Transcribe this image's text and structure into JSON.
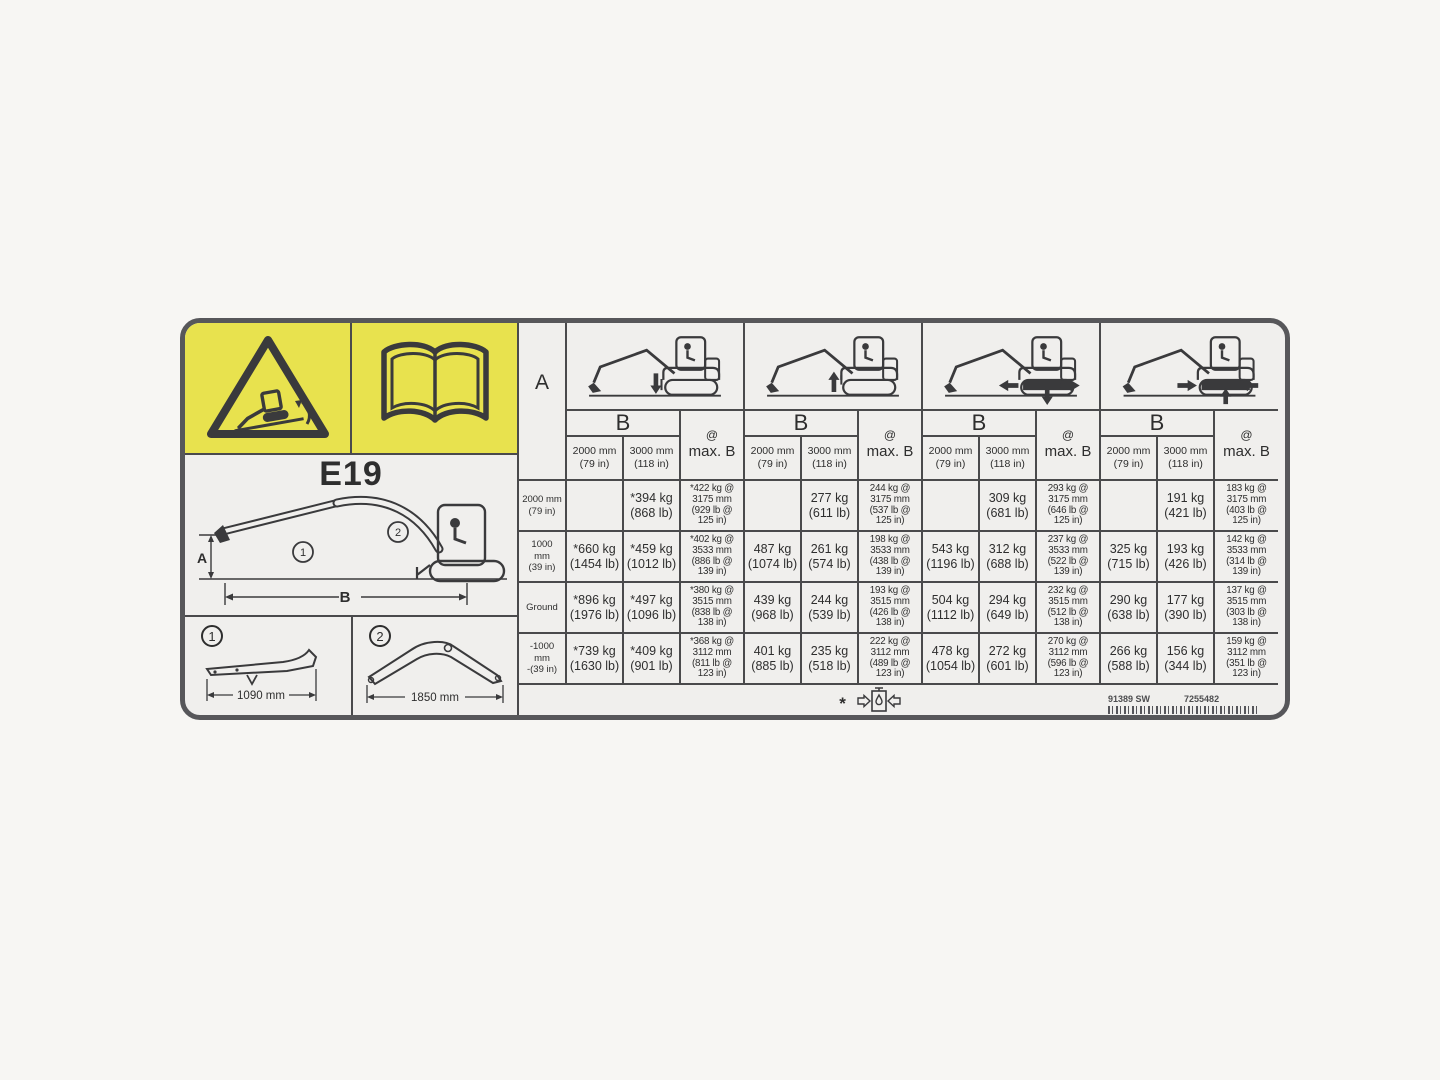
{
  "decal": {
    "model": "E19",
    "colors": {
      "panel_yellow": "#e8e24e",
      "border_gray": "#57575a",
      "background": "#f0efed",
      "line": "#4a4a4c"
    },
    "icons": {
      "warning": "tipping-excavator-warning-triangle",
      "manual": "operators-manual-book",
      "hydraulic": "hydraulic-capacity-limit",
      "group_icons": [
        "excavator-blade-down",
        "excavator-blade-up",
        "excavator-tracks-extended",
        "excavator-tracks-retracted"
      ]
    },
    "diagram": {
      "label_a": "A",
      "label_b": "B",
      "marker_1": "1",
      "marker_2": "2"
    },
    "arm_options": [
      {
        "marker": "1",
        "dimension": "1090 mm"
      },
      {
        "marker": "2",
        "dimension": "1850 mm"
      }
    ],
    "footer": {
      "asterisk": "*",
      "part_number_left": "91389 SW",
      "part_number_right": "7255482"
    }
  },
  "table": {
    "corner_label": "A",
    "b_label": "B",
    "at_symbol": "@",
    "max_b_label": "max. B",
    "b_columns": [
      "2000 mm\n(79 in)",
      "3000 mm\n(118 in)"
    ],
    "row_headers": [
      "2000 mm\n(79 in)",
      "1000\nmm\n(39 in)",
      "Ground",
      "-1000\nmm\n-(39 in)"
    ],
    "groups": [
      {
        "icon": "excavator-blade-down",
        "rows": [
          [
            "",
            "*394 kg\n(868 lb)",
            "*422 kg @\n3175 mm\n(929 lb @\n125 in)"
          ],
          [
            "*660 kg\n(1454 lb)",
            "*459 kg\n(1012 lb)",
            "*402 kg @\n3533 mm\n(886 lb @\n139 in)"
          ],
          [
            "*896 kg\n(1976 lb)",
            "*497 kg\n(1096 lb)",
            "*380 kg @\n3515 mm\n(838 lb @\n138 in)"
          ],
          [
            "*739 kg\n(1630 lb)",
            "*409 kg\n(901 lb)",
            "*368 kg @\n3112 mm\n(811 lb @\n123 in)"
          ]
        ]
      },
      {
        "icon": "excavator-blade-up",
        "rows": [
          [
            "",
            "277 kg\n(611 lb)",
            "244 kg @\n3175 mm\n(537 lb @\n125 in)"
          ],
          [
            "487 kg\n(1074 lb)",
            "261 kg\n(574 lb)",
            "198 kg @\n3533 mm\n(438 lb @\n139 in)"
          ],
          [
            "439 kg\n(968 lb)",
            "244 kg\n(539 lb)",
            "193 kg @\n3515 mm\n(426 lb @\n138 in)"
          ],
          [
            "401 kg\n(885 lb)",
            "235 kg\n(518 lb)",
            "222 kg @\n3112 mm\n(489 lb @\n123 in)"
          ]
        ]
      },
      {
        "icon": "excavator-tracks-extended",
        "rows": [
          [
            "",
            "309 kg\n(681 lb)",
            "293 kg @\n3175 mm\n(646 lb @\n125 in)"
          ],
          [
            "543 kg\n(1196 lb)",
            "312 kg\n(688 lb)",
            "237 kg @\n3533 mm\n(522 lb @\n139 in)"
          ],
          [
            "504 kg\n(1112 lb)",
            "294 kg\n(649 lb)",
            "232 kg @\n3515 mm\n(512 lb @\n138 in)"
          ],
          [
            "478 kg\n(1054 lb)",
            "272 kg\n(601 lb)",
            "270 kg @\n3112 mm\n(596 lb @\n123 in)"
          ]
        ]
      },
      {
        "icon": "excavator-tracks-retracted",
        "rows": [
          [
            "",
            "191 kg\n(421 lb)",
            "183 kg @\n3175 mm\n(403 lb @\n125 in)"
          ],
          [
            "325 kg\n(715 lb)",
            "193 kg\n(426 lb)",
            "142 kg @\n3533 mm\n(314 lb @\n139 in)"
          ],
          [
            "290 kg\n(638 lb)",
            "177 kg\n(390 lb)",
            "137 kg @\n3515 mm\n(303 lb @\n138 in)"
          ],
          [
            "266 kg\n(588 lb)",
            "156 kg\n(344 lb)",
            "159 kg @\n3112 mm\n(351 lb @\n123 in)"
          ]
        ]
      }
    ]
  }
}
